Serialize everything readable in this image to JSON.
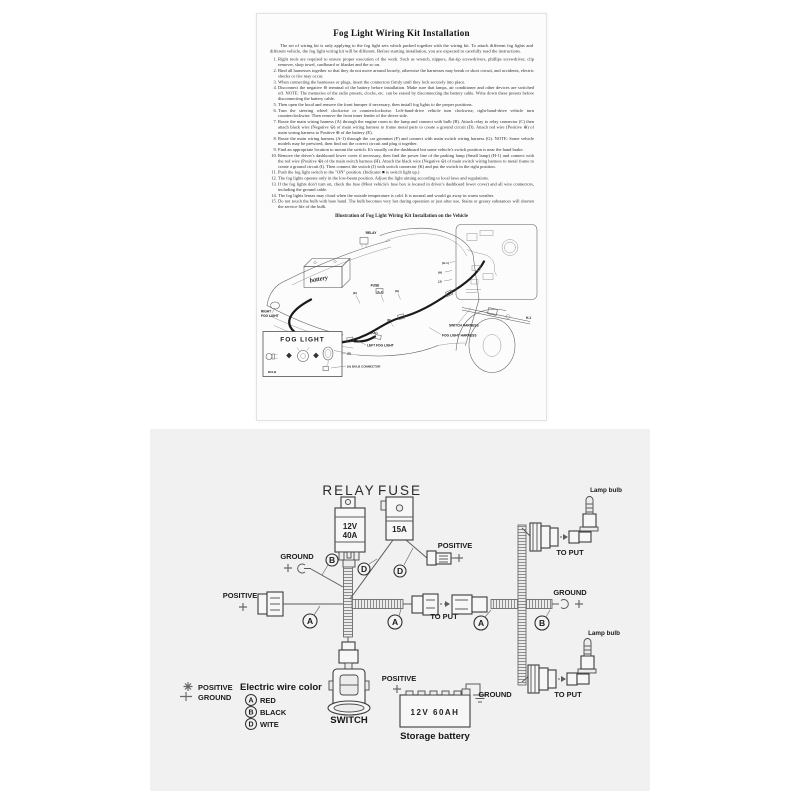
{
  "sheet": {
    "title": "Fog Light Wiring Kit Installation",
    "intro": "The set of wiring kit is only applying to the fog light sets which packed together with the wiring kit. To attach different fog lights and different vehicle, the fog light wiring kit will be different. Before starting installation, you are expected to carefully read the instructions.",
    "instructions": [
      "Right tools are required to ensure proper execution of the work. Such as wrench, nippers, flat-tip screwdrivers, phillips screwdriver, clip remover, shop towel, cardboard or blanket and the so on.",
      "Bind all harnesses together so that they do not move around loosely, otherwise the harnesses may break or short circuit, and accidents, electric shocks or fire may occur.",
      "When connecting the harnesses or plugs, insert the connectors firmly until they lock securely into place.",
      "Disconnect the negative ⊖ terminal of the battery before installation. Make sure that lamps, air conditioner and other devices are switched off. NOTE: The memories of the radio presets, clocks, etc. can be erased by disconnecting the battery cable. Write down these presets before disconnecting the battery cable.",
      "Then open the hood and remove the front bumper if necessary, then install fog lights to the proper positions.",
      "Turn the steering wheel clockwise or counterclockwise. Left-hand-drive vehicle turn clockwise, right-hand-drive vehicle turn counterclockwise. Then remove the front inner fender of the driver side.",
      "Route the main wiring harness (A) through the engine room to the lamp and connect with bulb (B). Attach relay to relay connector (C) then attach black wire (Negative ⊖) of main wiring harness to frame metal parts to create a ground circuit (D). Attach red wire (Positive ⊕) of main wiring harness to Positive ⊕ of the battery (E).",
      "Route the main wiring harness (A-1) through the car grommet (F) and connect with main switch wiring harness (G). NOTE: Some vehicle models may be prewired, then find out the correct circuit and plug it together.",
      "Find an appropriate location to mount the switch. It's usually on the dashboard but some vehicle's switch position is near the hand brake.",
      "Remove the driver's dashboard lower cover if necessary, then find the power line of the parking lamp (Small lamp) (H-1) and connect with the red wire (Positive ⊕) of the main switch harness (H). Attach the black wire (Negative ⊖) of main switch wiring harness to metal frame to create a ground circuit (I). Then connect the switch (J) with switch connector (K) and put the switch in the right position.",
      "Push the fog light switch to the \"ON\" position. (Indicator ■ is switch light up.)",
      "The fog lights operate only in the low-beam position. Adjust the light aiming according to local laws and regulations.",
      "If the fog lights don't turn on, check the fuse (Most vehicle's fuse box is located in driver's dashboard lower cover) and all wire connectors, including the ground cable.",
      "The fog lights lenses may cloud when the outside temperature is cold. It is normal and would go away in warm weather.",
      "Do not touch the bulb with bare hand. The bulb becomes very hot during operation or just after use. Stains or greasy substances will shorten the service life of the bulb."
    ],
    "illustration": {
      "caption": "Illustration of Fog Light Wiring Kit Installation on the Vehicle",
      "relay": "RELAY",
      "fuse": "FUSE",
      "battery": "battery",
      "right_fog_light_line1": "RIGHT",
      "right_fog_light_line2": "FOG LIGHT",
      "left_fog_light": "LEFT FOG LIGHT",
      "switch_harness": "SWITCH HARNESS",
      "fog_light_harness": "FOG LIGHT HARNESS",
      "fog_light_box_title": "FOG LIGHT",
      "bulb": "BULB",
      "bulb_connector": "(A) BULB CONNECTOR",
      "tag_b": "(B)",
      "tag_ab": "(A/B)",
      "tag_e": "(E)",
      "tag_a1": "(A-1)",
      "tag_g": "(G)",
      "tag_d": "(D)",
      "tag_h": "(H)",
      "tag_h1": "(H-1)",
      "tag_j": "(J)",
      "h1_part": "H-1"
    }
  },
  "diagram": {
    "relay_label": "RELAY",
    "relay_spec_1": "12V",
    "relay_spec_2": "40A",
    "fuse_label": "FUSE",
    "fuse_spec": "15A",
    "positive": "POSITIVE",
    "ground": "GROUND",
    "to_put": "TO PUT",
    "lamp_bulb": "Lamp bulb",
    "switch_label": "SWITCH",
    "battery_spec": "12V 60AH",
    "battery_name": "Storage battery",
    "wire_a": "A",
    "wire_b": "B",
    "wire_d": "D",
    "legend": {
      "positive": "POSITIVE",
      "ground": "GROUND",
      "title": "Electric wire color",
      "a_color": "RED",
      "b_color": "BLACK",
      "d_color": "WITE"
    },
    "colors": {
      "panel_bg": "#f1f1f1",
      "paper_bg": "#fcfcfc",
      "line": "#3c3c3c",
      "harness_dark": "#1a1a1a"
    }
  }
}
